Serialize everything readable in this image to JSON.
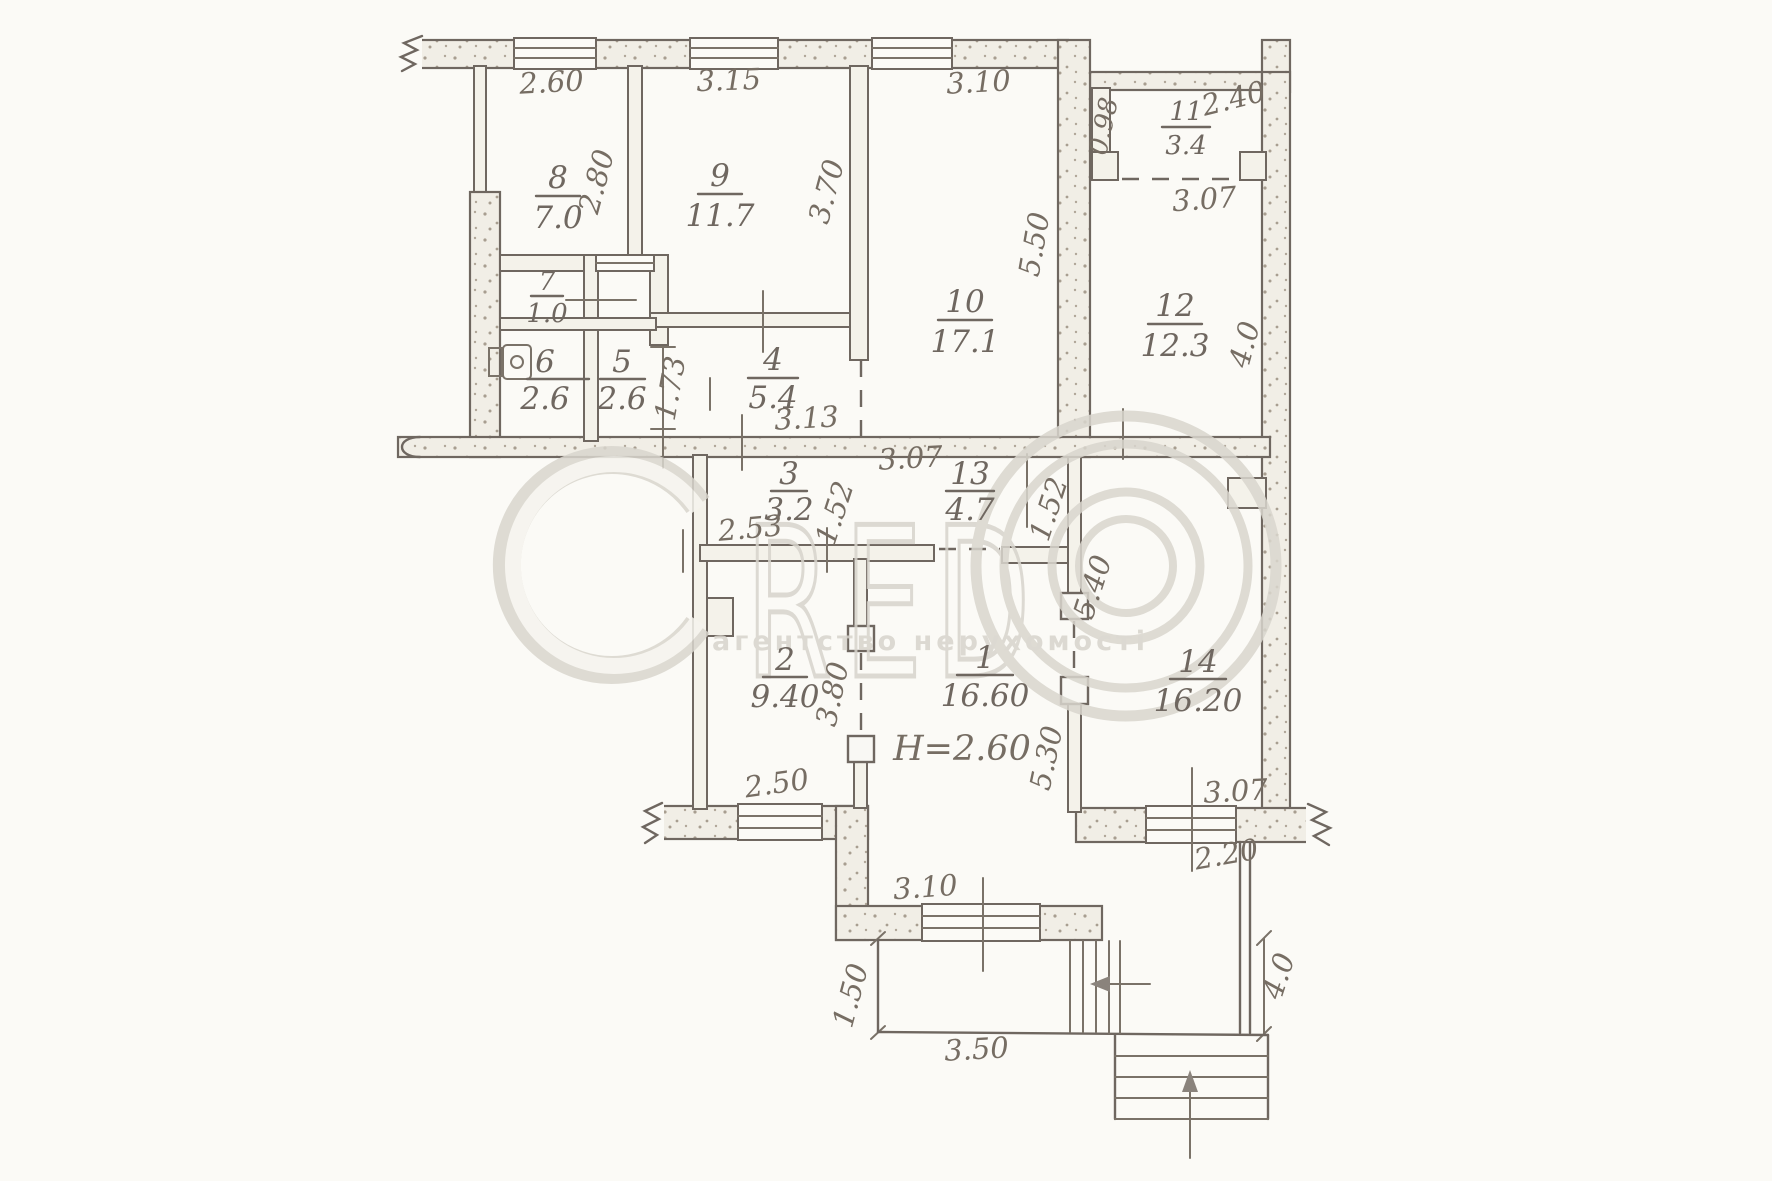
{
  "rooms": {
    "r1": {
      "num": "1",
      "area": "16.60"
    },
    "r2": {
      "num": "2",
      "area": "9.40"
    },
    "r3": {
      "num": "3",
      "area": "3.2"
    },
    "r4": {
      "num": "4",
      "area": "5.4"
    },
    "r5": {
      "num": "5",
      "area": "2.6"
    },
    "r6": {
      "num": "6",
      "area": "2.6"
    },
    "r7": {
      "num": "7",
      "area": "1.0"
    },
    "r8": {
      "num": "8",
      "area": "7.0"
    },
    "r9": {
      "num": "9",
      "area": "11.7"
    },
    "r10": {
      "num": "10",
      "area": "17.1"
    },
    "r11": {
      "num": "11",
      "area": "3.4"
    },
    "r12": {
      "num": "12",
      "area": "12.3"
    },
    "r13": {
      "num": "13",
      "area": "4.7"
    },
    "r14": {
      "num": "14",
      "area": "16.20"
    }
  },
  "dims": {
    "top_room8": "2.60",
    "top_room9": "3.15",
    "top_room10": "3.10",
    "side_room8": "2.80",
    "side_room9": "3.70",
    "side_room10": "5.50",
    "room11_width": "2.40",
    "room11_wall": "0.98",
    "room12_width": "3.07",
    "side_room12": "4.0",
    "hall_upper": "1.73",
    "room4_width": "3.13",
    "corridor_width": "3.07",
    "room3_width": "2.53",
    "room3_side": "1.52",
    "room13_side": "1.52",
    "room14_span": "5.40",
    "room2_side": "3.80",
    "room1_span": "5.30",
    "room2_window": "2.50",
    "room14_window": "3.07",
    "room14_lower": "2.20",
    "room1_window": "3.10",
    "porch_depth": "1.50",
    "porch_width": "3.50",
    "stairs_side": "4.0",
    "ceiling_height": "H=2.60"
  },
  "watermark": {
    "letter_c": "C",
    "letters": "RED",
    "tagline": "агентство нерухомості"
  }
}
